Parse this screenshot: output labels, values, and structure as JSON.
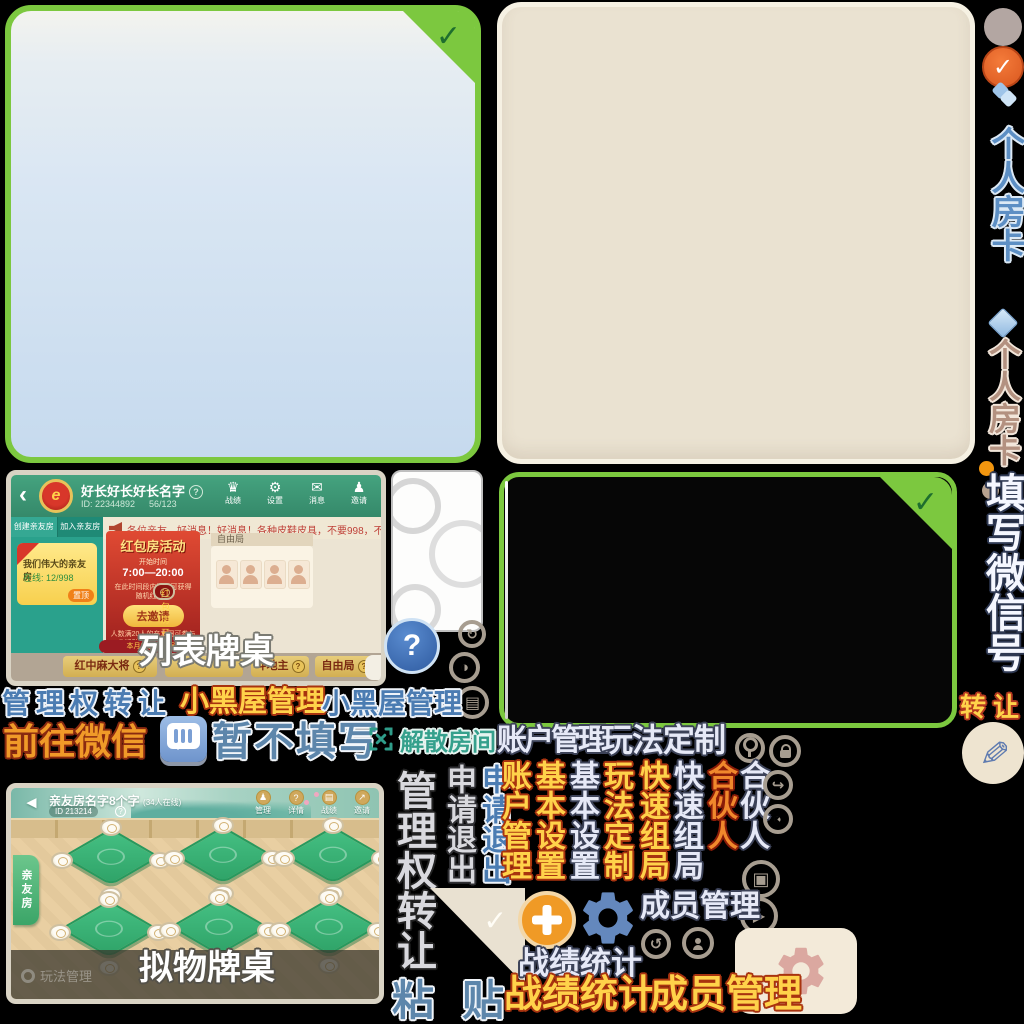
{
  "colors": {
    "sprite_green_border": "#7cc83f",
    "panel_beige": "#eae2d1",
    "gold_text": "#ffd24a",
    "gold_outline": "#a8330f",
    "blue_text": "#4b7cb2",
    "lavender_text": "#e6e9f7",
    "teal_text": "#35a08c",
    "orange_button": "#f09a26",
    "gear_blue": "#6488bd",
    "gear_rose": "#dba8a0",
    "header_green": "#45a37f",
    "banner_red": "#c03327",
    "table_green": "#37b277"
  },
  "glyphs": {
    "check": "✓",
    "question": "?",
    "back_thin": "‹",
    "back_solid": "◄",
    "trophy": "♛",
    "gear": "⚙",
    "mail": "✉",
    "pawn": "♟",
    "play": "▶",
    "window": "▣",
    "grid": "▤",
    "half": "◑",
    "redo": "↻",
    "undo": "↺",
    "pac": "◔",
    "share": "↪",
    "pen": "✎",
    "arrow_ne": "↗",
    "emblem_letter": "e"
  },
  "rail": {
    "card_blue": "个人房卡",
    "card_tan": "个人房卡",
    "fill_wechat": "填写微信号",
    "transfer": "转让"
  },
  "row1": {
    "manage_transfer": "管理权转让",
    "blackroom_gold": "小黑屋管理",
    "blackroom_blue": "小黑屋管理"
  },
  "row2": {
    "goto_wechat": "前往微信",
    "not_fill": "暂不填写",
    "dissolve": "解散房间",
    "account": "账户管理",
    "custom": "玩法定制"
  },
  "vwords": {
    "manage_transfer": "管理权转让",
    "exit_gray": "申请退出",
    "exit_blue": "申请退出",
    "account_gold": "账户管理",
    "basic_gold": "基本设置",
    "basic_lav": "基本设置",
    "custom_gold": "玩法定制",
    "quick_gold": "快速组局",
    "quick_lav": "快速组局",
    "partner_red": "合伙人",
    "partner_lav": "合伙人"
  },
  "bottom": {
    "stats_lav": "战绩统计",
    "member_lav": "成员管理",
    "paste_a": "粘",
    "paste_b": "贴",
    "stats_gold": "战绩统计",
    "member_gold": "成员管理"
  },
  "lobby_list": {
    "title": "好长好长好长名字",
    "id": "ID: 22344892",
    "members": "56/123",
    "nav": [
      "战绩",
      "设置",
      "消息",
      "邀请"
    ],
    "tab_create": "创建亲友房",
    "tab_join": "加入亲友房",
    "room_card": {
      "name": "我们伟大的亲友房",
      "online": "在线: 12/998",
      "pin": "置顶"
    },
    "marquee": "各位亲友、好消息！好消息！各种皮鞋皮具，不要998，不要688，只要98元，只要9",
    "banner": {
      "title": "红包房活动",
      "time_label": "开始时间",
      "time": "7:00—20:00",
      "status": "红包房开启中",
      "desc": "在此时间段内开房可获得随机红包哦",
      "button": "去邀请",
      "note": "人数满20人的亲友圈可参与此活动，当前只有13人"
    },
    "free_label": "自由局",
    "month_note": "本月您参与牌局",
    "tabs": [
      "红中麻大将",
      "",
      "斗地主",
      "自由局"
    ],
    "overlay": "列表牌桌"
  },
  "lobby_table": {
    "title": "亲友房名字8个字",
    "online_suffix": "(34人在线)",
    "id": "ID 213214",
    "nav": [
      "管理",
      "详情",
      "战绩",
      "邀请"
    ],
    "side_tab": "亲友房",
    "manage_play": "玩法管理",
    "overlay": "拟物牌桌"
  }
}
